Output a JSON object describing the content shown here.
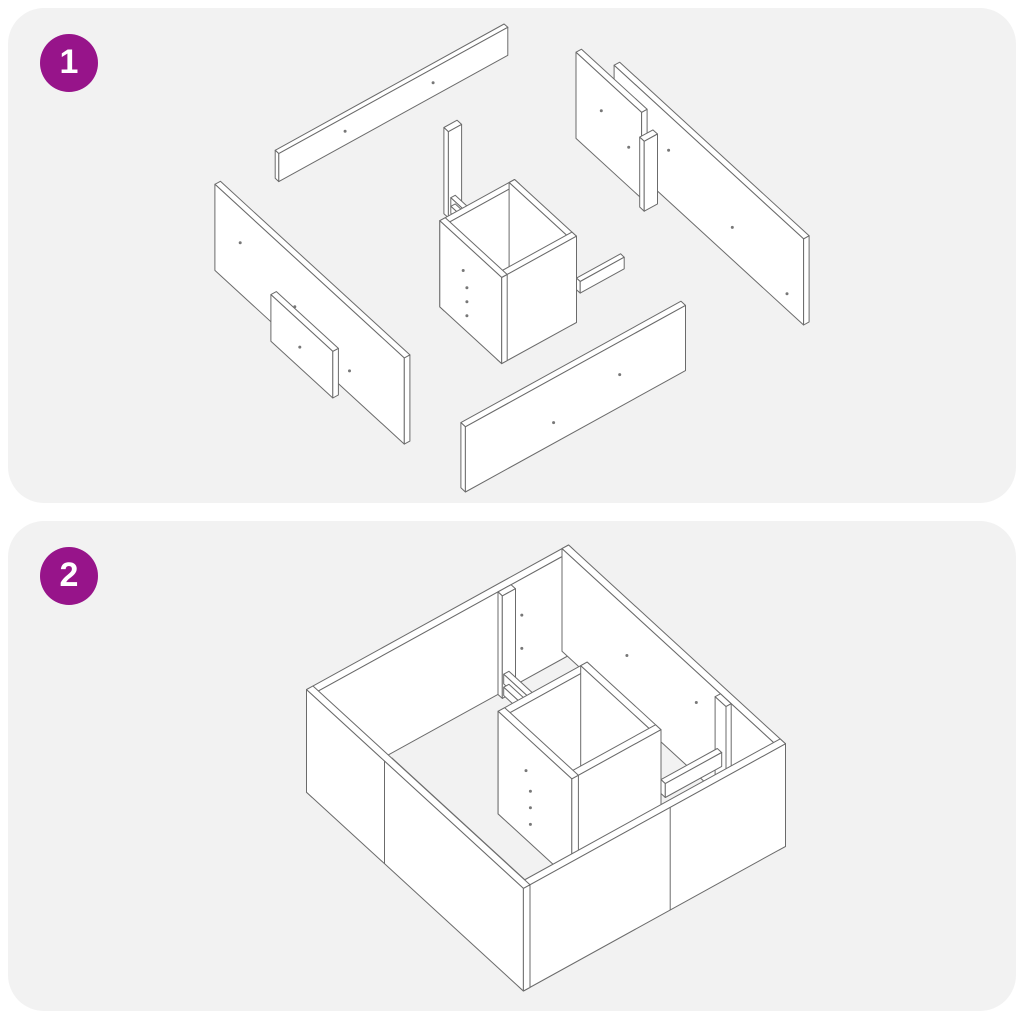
{
  "page": {
    "type": "assembly-instruction-sheet",
    "background": "#ffffff"
  },
  "colors": {
    "badge_background": "#97148a",
    "badge_text": "#ffffff",
    "panel_background": "#f2f2f2",
    "line": "#6b6b6b",
    "panel_fill": "#ffffff",
    "dot": "#777777"
  },
  "steps": [
    {
      "number": "1",
      "illustration": "exploded-view-of-bed-frame-panels"
    },
    {
      "number": "2",
      "illustration": "assembled-bed-frame-with-storage-compartments"
    }
  ]
}
